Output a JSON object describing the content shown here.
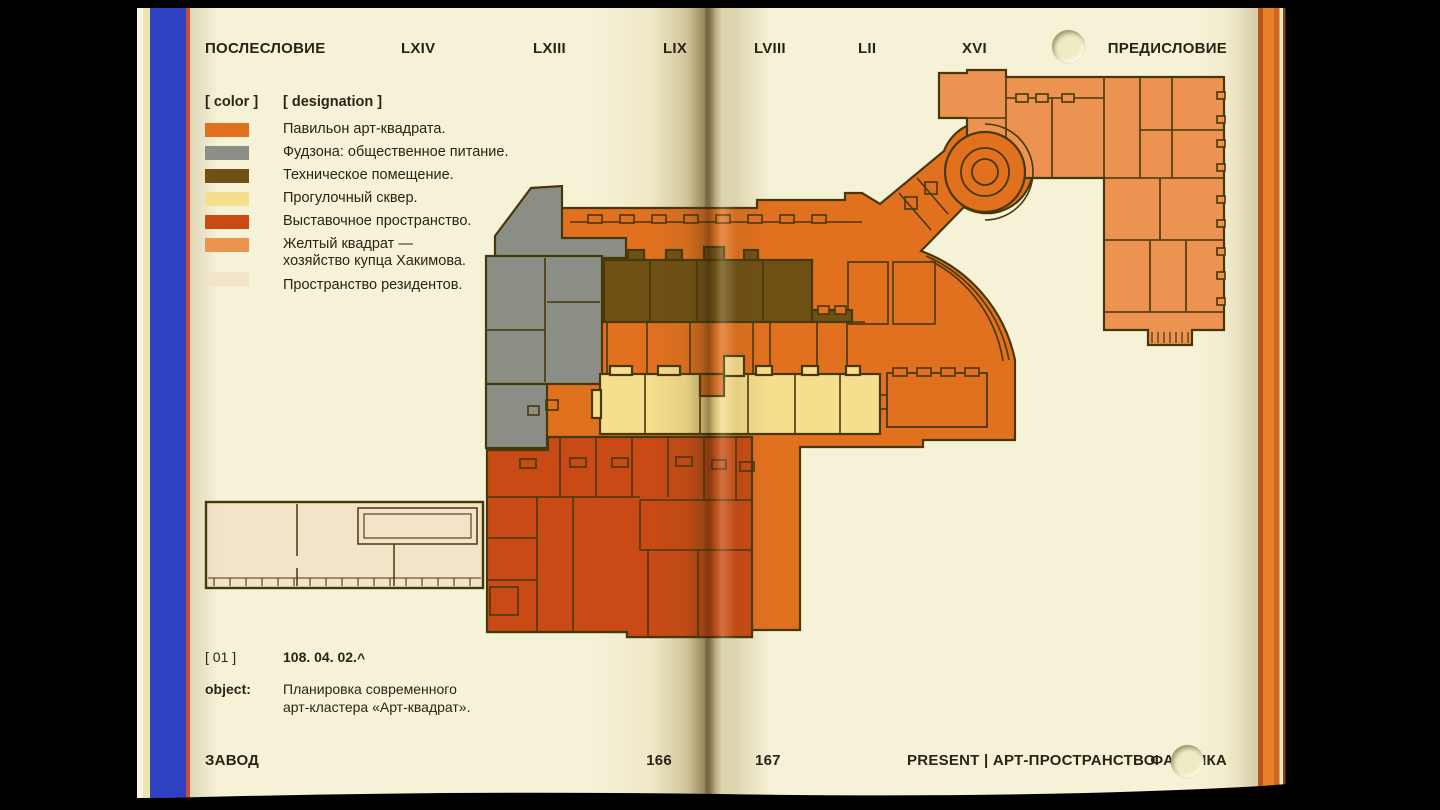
{
  "header": {
    "afterword": "ПОСЛЕСЛОВИЕ",
    "nav": [
      "LXIV",
      "LXIII",
      "LIX",
      "LVIII",
      "LII",
      "XVI"
    ],
    "preface": "ПРЕДИСЛОВИЕ"
  },
  "legend": {
    "color_header": "[ color ]",
    "designation_header": "[ designation ]",
    "items": [
      {
        "label": "Павильон арт-квадрата.",
        "color_key": "pavilion"
      },
      {
        "label": "Фудзона: общественное питание.",
        "color_key": "foodzone"
      },
      {
        "label": "Техническое помещение.",
        "color_key": "technical"
      },
      {
        "label": "Прогулочный сквер.",
        "color_key": "park"
      },
      {
        "label": "Выставочное пространство.",
        "color_key": "exhibition"
      },
      {
        "label": "Желтый квадрат —\nхозяйство купца Хакимова.",
        "color_key": "yellow_square"
      },
      {
        "label": "Пространство резидентов.",
        "color_key": "residents"
      }
    ]
  },
  "caption": {
    "index": "[ 01 ]",
    "code": "108. 04. 02.",
    "caret": "^",
    "object_label": "object:",
    "object_text": "Планировка современного\nарт-кластера «Арт-квадрат»."
  },
  "footer": {
    "left": "ЗАВОД",
    "page_left": "166",
    "page_right": "167",
    "right_label": "PRESENT | АРТ-ПРОСТРАНСТВО",
    "far_right": "ФАБРИКА"
  },
  "colors": {
    "pavilion": "#E2711F",
    "foodzone": "#8A8E85",
    "technical": "#6F5116",
    "park": "#F5DE8E",
    "exhibition": "#C94A14",
    "yellow_square": "#EC9351",
    "residents": "#F2E3C9",
    "outline": "#463809",
    "page": "#F6F2D8",
    "spine_blue": "#2E41C0",
    "spine_red": "#CC4F30",
    "page_edge_orange": "#E8812C",
    "text": "#2B2416"
  }
}
